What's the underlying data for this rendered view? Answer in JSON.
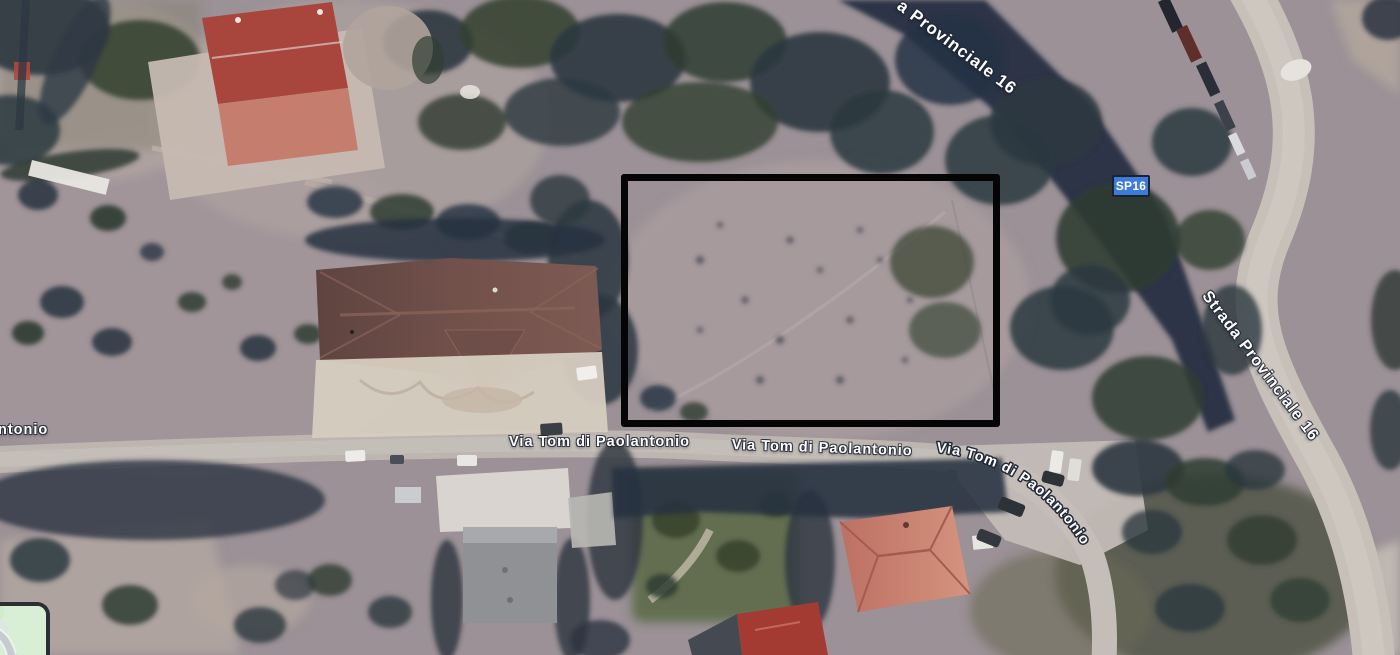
{
  "view": {
    "mode": "satellite",
    "description": "Aerial satellite view of a parcel along Via Tom di Paolantonio near Strada Provinciale 16, outlined with a black rectangle"
  },
  "road_labels": {
    "provinciale_top_clipped": "a Provinciale 16",
    "provinciale_right": "Strada Provinciale 16",
    "via_left_clipped": "ntonio",
    "via_1": "Via Tom di Paolantonio",
    "via_2": "Via Tom di Paolantonio",
    "via_3_curved": "Via Tom di Paolantonio"
  },
  "route_badge": {
    "label": "SP16",
    "background": "#3E7BD8",
    "border": "#1A232E",
    "text_color": "#FFFFFF"
  },
  "annotation": {
    "type": "rectangle-outline",
    "stroke_color": "#000000",
    "stroke_px": 7,
    "x": 621,
    "y": 174,
    "width": 379,
    "height": 253
  },
  "minimap": {
    "role": "map-layer-toggle",
    "land_color": "#D9EFD5",
    "road_color": "#C6CBD0",
    "border_color": "#2B2F34"
  },
  "palette": {
    "ground": "#9B9196",
    "field": "#A79B9D",
    "road": "#C0B9B3",
    "vegetation_dark": "#2C3644",
    "vegetation_olive": "#3C4836",
    "roof_red_dark": "#A8453C",
    "roof_red_light": "#C57E6E",
    "roof_brown": "#6B4C47",
    "roof_salmon": "#C9897A",
    "label_text": "#FFFFFF"
  }
}
